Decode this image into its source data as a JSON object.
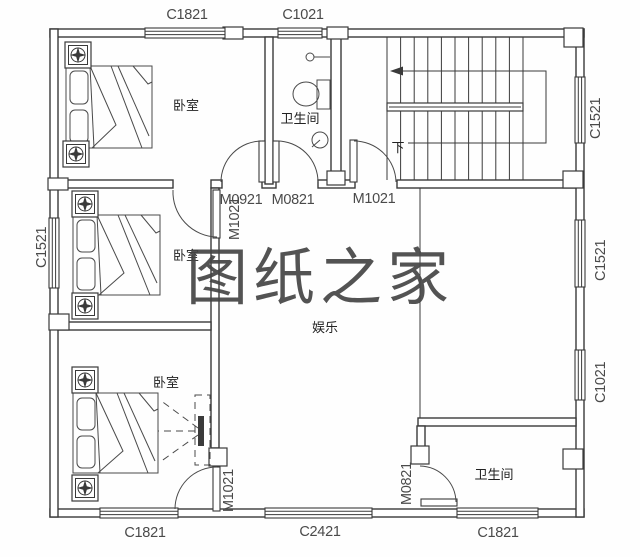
{
  "watermark": {
    "text": "图纸之家",
    "color": "#d83a3c"
  },
  "rooms": [
    {
      "name": "bedroom-1",
      "label": "卧室"
    },
    {
      "name": "bathroom-1",
      "label": "卫生间"
    },
    {
      "name": "bedroom-2",
      "label": "卧室"
    },
    {
      "name": "bedroom-3",
      "label": "卧室"
    },
    {
      "name": "recreation",
      "label": "娱乐"
    },
    {
      "name": "bathroom-2",
      "label": "卫生间"
    }
  ],
  "stairs": {
    "down_label": "下"
  },
  "windows": [
    {
      "code": "C1821",
      "position": "top-left"
    },
    {
      "code": "C1021",
      "position": "top-middle"
    },
    {
      "code": "C1521",
      "position": "right-upper"
    },
    {
      "code": "C1521",
      "position": "right-middle"
    },
    {
      "code": "C1021",
      "position": "right-lower"
    },
    {
      "code": "C1521",
      "position": "left"
    },
    {
      "code": "C1821",
      "position": "bottom-left"
    },
    {
      "code": "C2421",
      "position": "bottom-middle"
    },
    {
      "code": "C1821",
      "position": "bottom-right"
    }
  ],
  "doors": [
    {
      "code": "M0921",
      "room": "bedroom-1"
    },
    {
      "code": "M0821",
      "room": "bathroom-1"
    },
    {
      "code": "M1021",
      "room": "stair-hall"
    },
    {
      "code": "M1021",
      "room": "bedroom-2"
    },
    {
      "code": "M1021",
      "room": "bedroom-3"
    },
    {
      "code": "M0821",
      "room": "bathroom-2"
    }
  ]
}
